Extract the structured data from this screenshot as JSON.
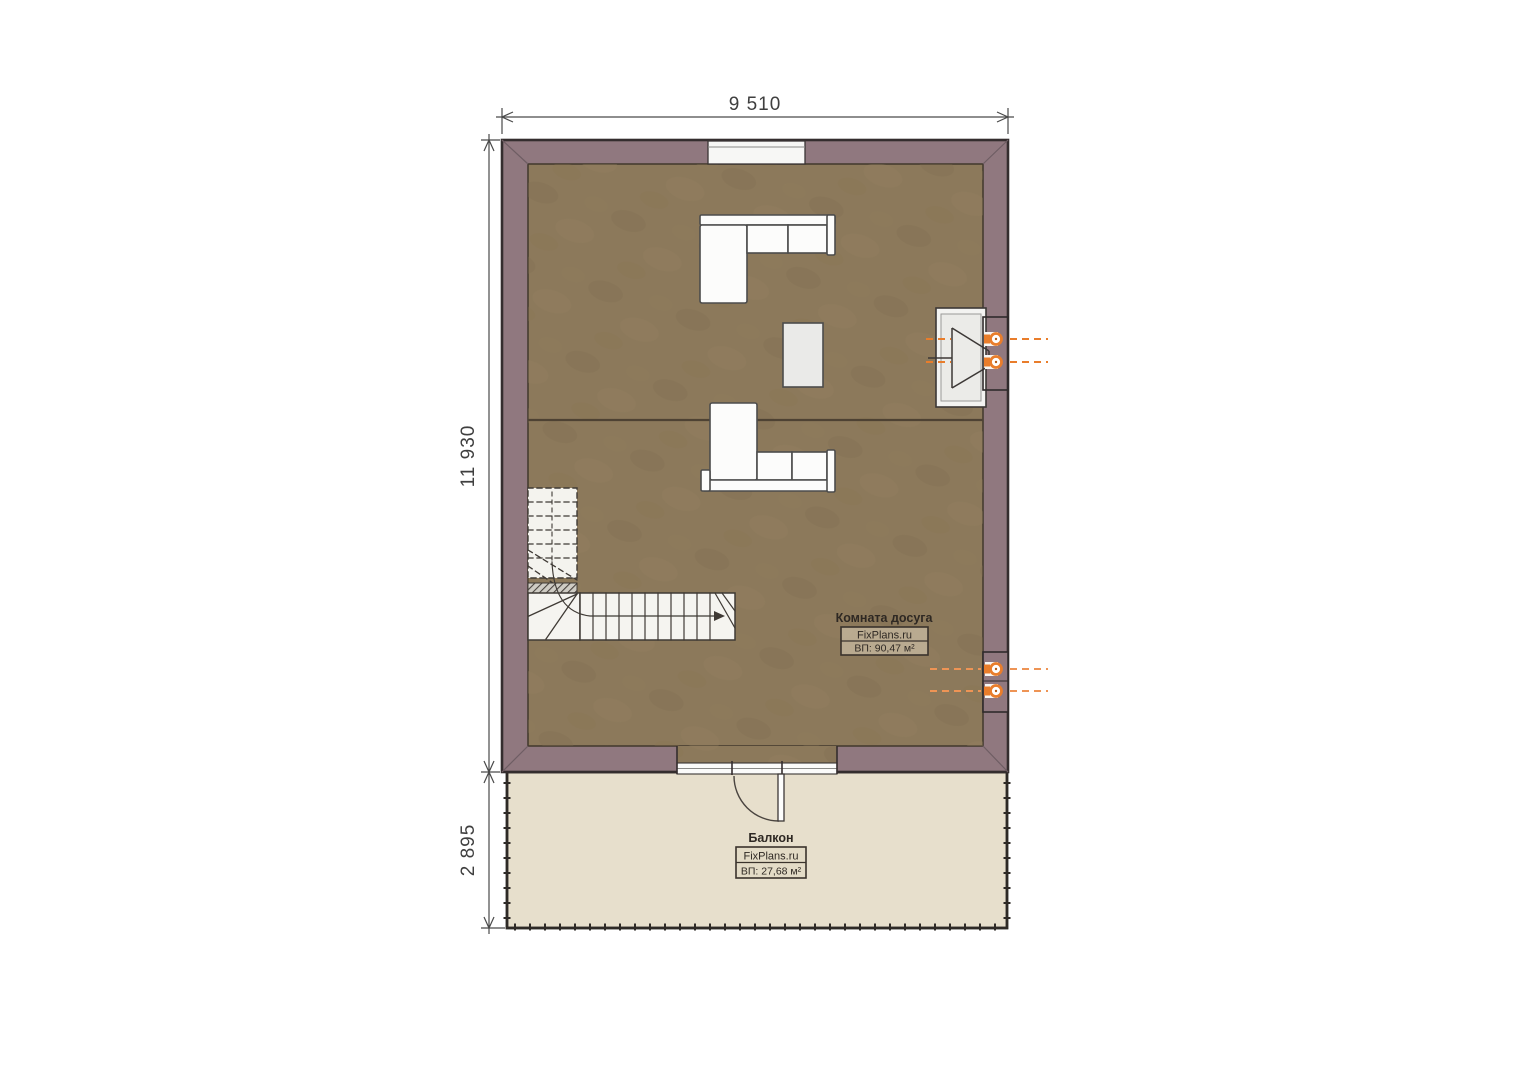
{
  "dimensions": {
    "width_top": "9 510",
    "height_main": "11 930",
    "height_balcony": "2 895"
  },
  "rooms": {
    "leisure": {
      "name": "Комната досуга",
      "brand": "FixPlans.ru",
      "area": "ВП: 90,47 м²"
    },
    "balcony": {
      "name": "Балкон",
      "brand": "FixPlans.ru",
      "area": "ВП: 27,68 м²"
    }
  },
  "colors": {
    "wall": "#90787f",
    "wall_outline": "#342d2e",
    "floor": "#8c795b",
    "balcony_floor": "#e7dfcc",
    "furniture_white": "#fcfcfb",
    "accent_orange": "#e97d2b",
    "dimension_text": "#3f3f3f"
  }
}
